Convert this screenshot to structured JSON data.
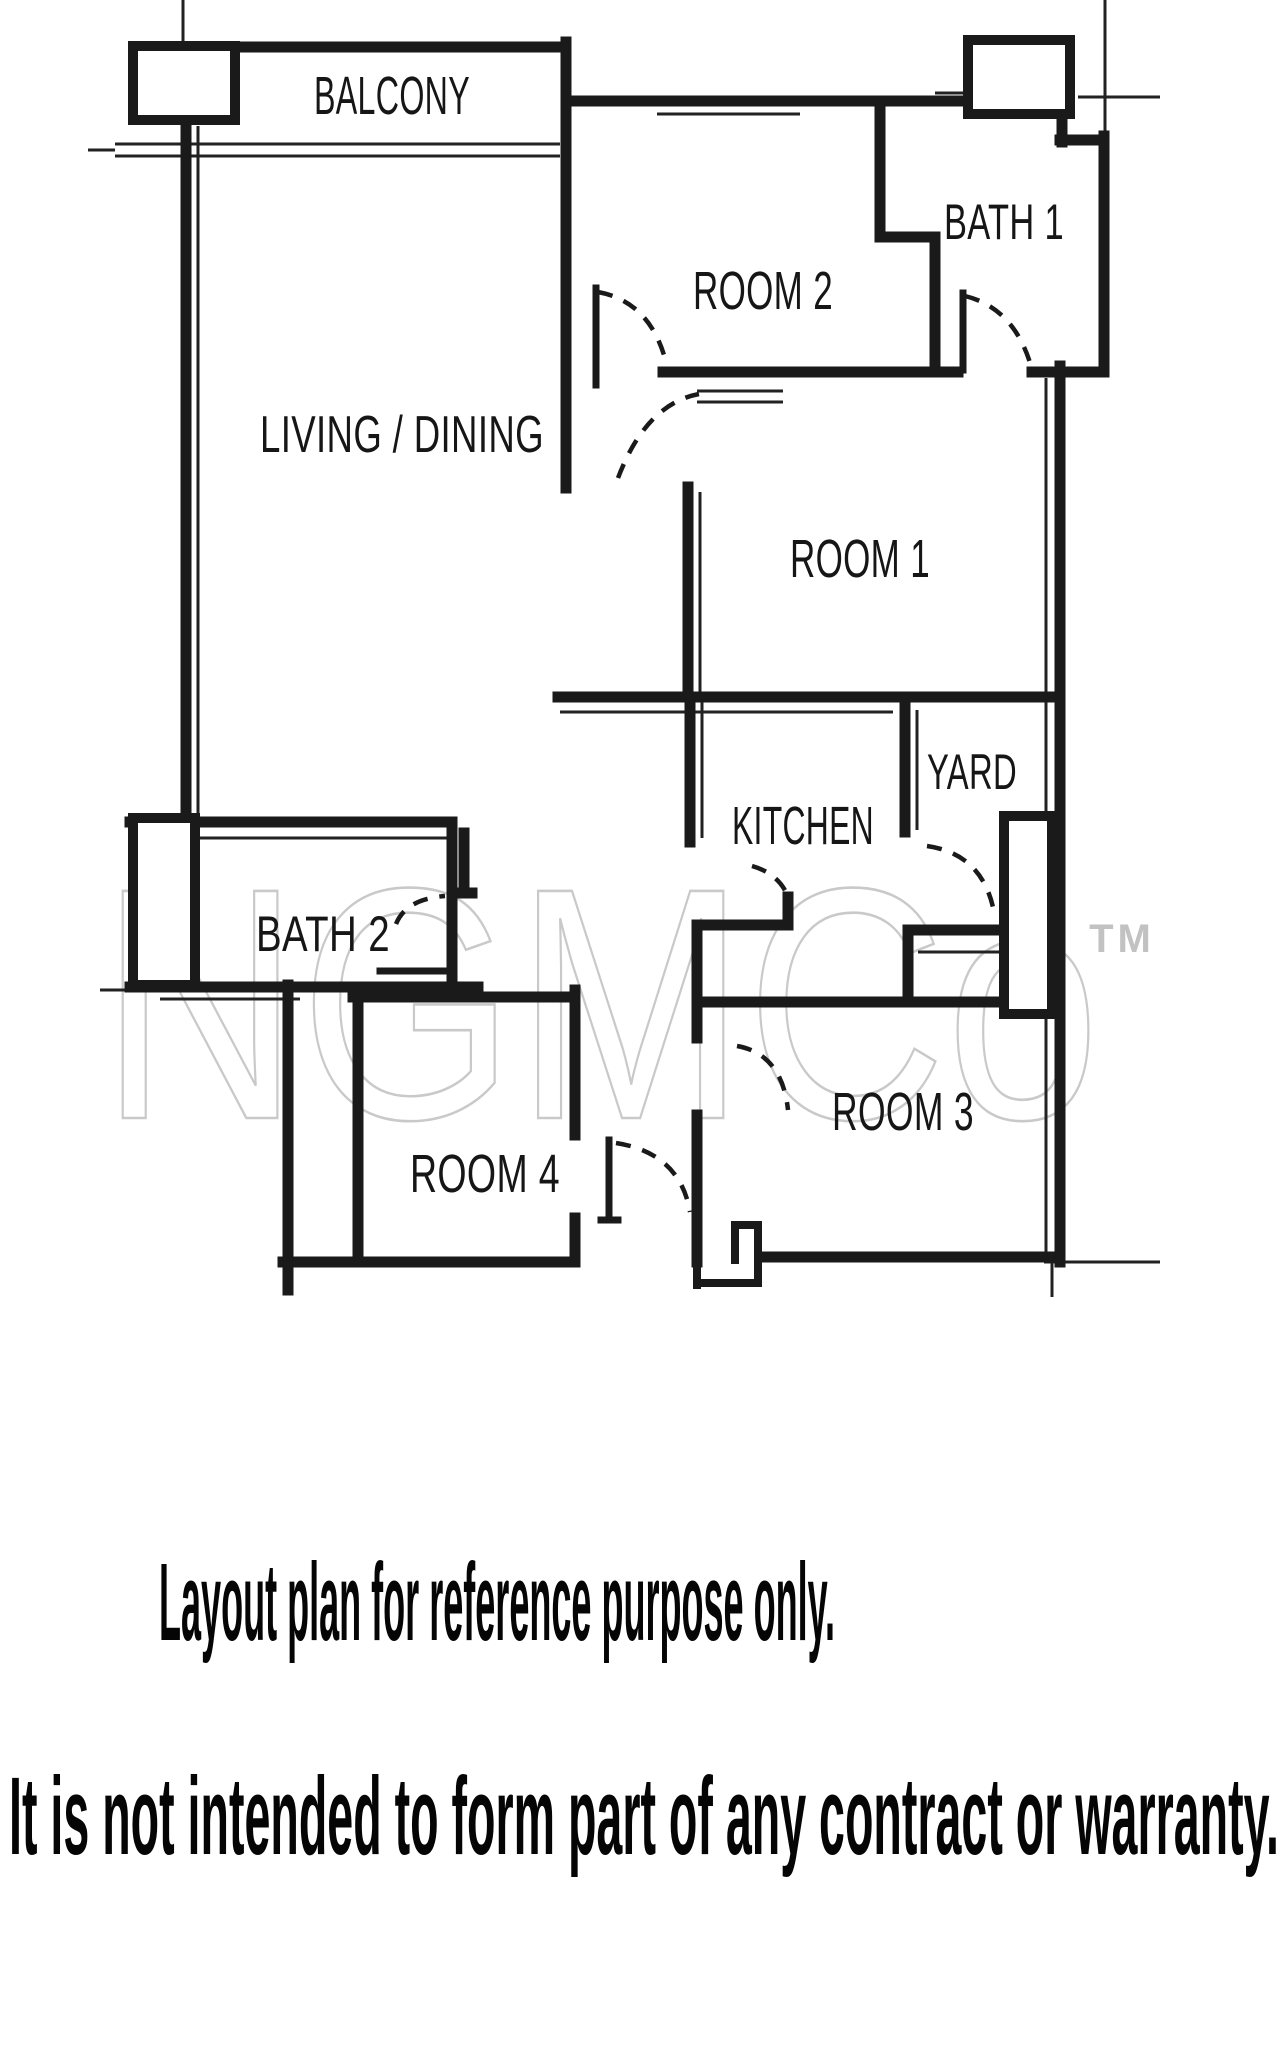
{
  "plan": {
    "rooms": [
      {
        "id": "balcony",
        "label": "BALCONY"
      },
      {
        "id": "room-2",
        "label": "ROOM 2"
      },
      {
        "id": "bath-1",
        "label": "BATH 1"
      },
      {
        "id": "living-dining",
        "label": "LIVING / DINING"
      },
      {
        "id": "room-1",
        "label": "ROOM 1"
      },
      {
        "id": "kitchen",
        "label": "KITCHEN"
      },
      {
        "id": "yard",
        "label": "YARD"
      },
      {
        "id": "bath-2",
        "label": "BATH 2"
      },
      {
        "id": "room-4",
        "label": "ROOM 4"
      },
      {
        "id": "room-3",
        "label": "ROOM 3"
      }
    ],
    "watermark": {
      "text": "NGMCo",
      "tm": "TM",
      "color": "#c9c9c9"
    },
    "colors": {
      "wall": "#1a1a1a",
      "background": "#ffffff",
      "label": "#161616"
    }
  },
  "disclaimer": {
    "line1": "Layout plan for reference purpose only.",
    "line2": "It is not intended to form part of any contract or warranty."
  }
}
